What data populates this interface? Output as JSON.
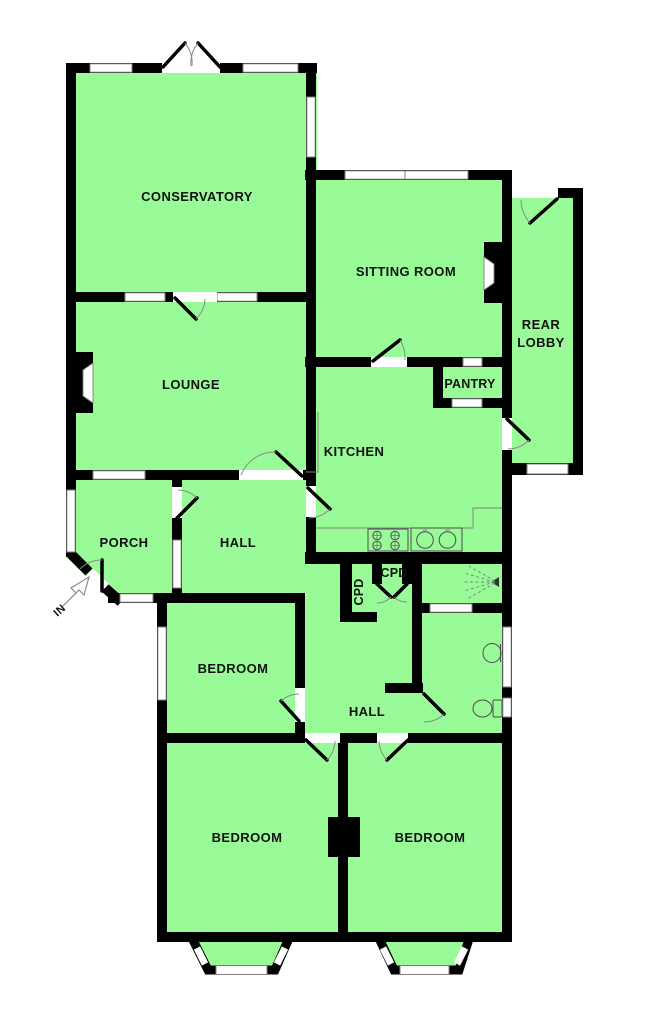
{
  "plan": {
    "type": "bungalow-floorplan",
    "colors": {
      "room_fill": "#98FB98",
      "wall": "#000000",
      "detail_line": "#7f7f7f"
    },
    "rooms": {
      "conservatory": {
        "label": "CONSERVATORY"
      },
      "sitting_room": {
        "label": "SITTING ROOM"
      },
      "rear_lobby": {
        "line1": "REAR",
        "line2": "LOBBY"
      },
      "lounge": {
        "label": "LOUNGE"
      },
      "pantry": {
        "label": "PANTRY"
      },
      "kitchen": {
        "label": "KITCHEN"
      },
      "porch": {
        "label": "PORCH"
      },
      "hall_front": {
        "label": "HALL"
      },
      "cupboard_1": {
        "label": "CPD"
      },
      "cupboard_2": {
        "label": "CPD"
      },
      "bedroom_middle": {
        "label": "BEDROOM"
      },
      "hall_rear": {
        "label": "HALL"
      },
      "bedroom_left": {
        "label": "BEDROOM"
      },
      "bedroom_right": {
        "label": "BEDROOM"
      }
    },
    "entrance": {
      "label": "IN"
    },
    "fixtures": [
      "hob",
      "double-sink",
      "shower",
      "wash-basin",
      "toilet",
      "fireplace-lounge",
      "fireplace-sitting-room",
      "chimney-breast-bedrooms",
      "bay-window-left",
      "bay-window-right"
    ]
  }
}
